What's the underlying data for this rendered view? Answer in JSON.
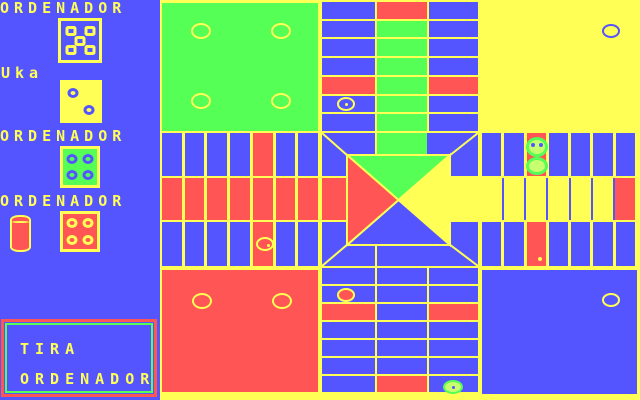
{
  "palette": {
    "blue": "#5555FF",
    "red": "#FF5555",
    "green": "#55FF55",
    "yellow": "#FFFF55"
  },
  "sidebar": {
    "rows": [
      {
        "label": "ORDENADOR"
      },
      {
        "label": "Uka"
      },
      {
        "label": "ORDENADOR"
      },
      {
        "label": "ORDENADOR"
      }
    ],
    "dice": [
      {
        "player": "ordenador-1",
        "value": 5,
        "face": "blue",
        "border": "yellow",
        "pip": "yellow",
        "pip_shape": "square",
        "x": 58,
        "y": 18,
        "w": 44,
        "h": 45
      },
      {
        "player": "Uka",
        "value": 2,
        "face": "yellow",
        "border": "yellow",
        "pip": "blue",
        "pip_shape": "round",
        "x": 60,
        "y": 80,
        "w": 42,
        "h": 43
      },
      {
        "player": "ordenador-2",
        "value": 4,
        "face": "green",
        "border": "yellow",
        "pip": "blue",
        "pip_shape": "round",
        "x": 60,
        "y": 146,
        "w": 40,
        "h": 42
      },
      {
        "player": "ordenador-3",
        "value": 4,
        "face": "red",
        "border": "yellow",
        "pip": "yellow",
        "pip_shape": "round",
        "x": 60,
        "y": 211,
        "w": 40,
        "h": 41
      }
    ],
    "action_box": {
      "line1": "TIRA",
      "line2": "ORDENADOR"
    }
  },
  "board": {
    "quadrants": [
      {
        "name": "green-home",
        "color": "green",
        "x": 162,
        "y": 3,
        "w": 156,
        "h": 128,
        "circles": [
          {
            "cx": 201,
            "cy": 31,
            "ring": "yellow",
            "rx": 10,
            "ry": 8
          },
          {
            "cx": 281,
            "cy": 31,
            "ring": "yellow",
            "rx": 10,
            "ry": 8
          },
          {
            "cx": 201,
            "cy": 101,
            "ring": "yellow",
            "rx": 10,
            "ry": 8
          },
          {
            "cx": 281,
            "cy": 101,
            "ring": "yellow",
            "rx": 10,
            "ry": 8
          }
        ]
      },
      {
        "name": "yellow-home",
        "color": "yellow",
        "x": 482,
        "y": 3,
        "w": 155,
        "h": 128,
        "circles": [
          {
            "cx": 611,
            "cy": 31,
            "ring": "blue",
            "rx": 9,
            "ry": 7
          }
        ]
      },
      {
        "name": "red-home",
        "color": "red",
        "x": 162,
        "y": 270,
        "w": 156,
        "h": 122,
        "circles": [
          {
            "cx": 202,
            "cy": 301,
            "ring": "yellow",
            "rx": 10,
            "ry": 8
          },
          {
            "cx": 282,
            "cy": 301,
            "ring": "yellow",
            "rx": 10,
            "ry": 8
          }
        ]
      },
      {
        "name": "blue-home",
        "color": "blue",
        "x": 482,
        "y": 270,
        "w": 155,
        "h": 124,
        "circles": [
          {
            "cx": 611,
            "cy": 300,
            "ring": "yellow",
            "rx": 9,
            "ry": 7
          }
        ]
      }
    ],
    "arms": [
      {
        "name": "arm-top-left-col",
        "x": 322,
        "y": 2,
        "w": 53,
        "h": 129,
        "dir": "rows",
        "gap": 2,
        "bg": "yellow",
        "cells": [
          "blue",
          "blue",
          "blue",
          "blue",
          "red",
          "blue",
          "blue"
        ]
      },
      {
        "name": "arm-top-mid-col",
        "x": 377,
        "y": 2,
        "w": 50,
        "h": 129,
        "dir": "rows",
        "gap": 2,
        "bg": "yellow",
        "cells": [
          "red",
          "green",
          "green",
          "green",
          "green",
          "green",
          "green"
        ]
      },
      {
        "name": "arm-top-right-col",
        "x": 429,
        "y": 2,
        "w": 49,
        "h": 129,
        "dir": "rows",
        "gap": 2,
        "bg": "yellow",
        "cells": [
          "blue",
          "blue",
          "blue",
          "blue",
          "red",
          "blue",
          "blue"
        ]
      },
      {
        "name": "arm-left-top-row",
        "x": 162,
        "y": 133,
        "w": 156,
        "h": 43,
        "dir": "cols",
        "gap": 3,
        "bg": "yellow",
        "cells": [
          "blue",
          "blue",
          "blue",
          "blue",
          "red",
          "blue",
          "blue"
        ]
      },
      {
        "name": "arm-left-mid-row",
        "x": 162,
        "y": 178,
        "w": 156,
        "h": 42,
        "dir": "cols",
        "gap": 3,
        "bg": "yellow",
        "cells": [
          "red",
          "red",
          "red",
          "red",
          "red",
          "red",
          "red"
        ]
      },
      {
        "name": "arm-left-bottom-row",
        "x": 162,
        "y": 222,
        "w": 156,
        "h": 44,
        "dir": "cols",
        "gap": 3,
        "bg": "yellow",
        "cells": [
          "blue",
          "blue",
          "blue",
          "blue",
          "red",
          "blue",
          "blue"
        ]
      },
      {
        "name": "arm-right-top-row",
        "x": 482,
        "y": 133,
        "w": 153,
        "h": 43,
        "dir": "cols",
        "gap": 3,
        "bg": "yellow",
        "cells": [
          "blue",
          "blue",
          "red",
          "blue",
          "blue",
          "blue",
          "blue"
        ]
      },
      {
        "name": "arm-right-mid-row",
        "x": 482,
        "y": 178,
        "w": 153,
        "h": 42,
        "dir": "cols",
        "gap": 2,
        "bg": "blue",
        "cells": [
          "yellow",
          "yellow",
          "yellow",
          "yellow",
          "yellow",
          "yellow",
          "red"
        ]
      },
      {
        "name": "arm-right-bottom-row",
        "x": 482,
        "y": 222,
        "w": 153,
        "h": 44,
        "dir": "cols",
        "gap": 3,
        "bg": "yellow",
        "cells": [
          "blue",
          "blue",
          "red",
          "blue",
          "blue",
          "blue",
          "blue"
        ]
      },
      {
        "name": "arm-bottom-left-col",
        "x": 322,
        "y": 268,
        "w": 53,
        "h": 124,
        "dir": "rows",
        "gap": 2,
        "bg": "yellow",
        "cells": [
          "blue",
          "blue",
          "red",
          "blue",
          "blue",
          "blue",
          "blue"
        ]
      },
      {
        "name": "arm-bottom-mid-col",
        "x": 377,
        "y": 268,
        "w": 50,
        "h": 124,
        "dir": "rows",
        "gap": 2,
        "bg": "yellow",
        "cells": [
          "blue",
          "blue",
          "blue",
          "blue",
          "blue",
          "blue",
          "red"
        ]
      },
      {
        "name": "arm-bottom-right-col",
        "x": 429,
        "y": 268,
        "w": 49,
        "h": 124,
        "dir": "rows",
        "gap": 2,
        "bg": "yellow",
        "cells": [
          "blue",
          "blue",
          "red",
          "blue",
          "blue",
          "blue",
          "blue"
        ]
      }
    ],
    "patches": [
      {
        "x": 322,
        "y": 133,
        "w": 53,
        "h": 43
      },
      {
        "x": 426,
        "y": 133,
        "w": 52,
        "h": 43
      },
      {
        "x": 322,
        "y": 222,
        "w": 53,
        "h": 44
      },
      {
        "x": 426,
        "y": 222,
        "w": 52,
        "h": 44
      }
    ],
    "entries": [
      {
        "name": "entry-green",
        "color": "green",
        "x": 377,
        "y": 133,
        "w": 50,
        "h": 21
      },
      {
        "name": "entry-red",
        "color": "red",
        "x": 322,
        "y": 178,
        "w": 24,
        "h": 42
      },
      {
        "name": "entry-yellow",
        "color": "yellow",
        "x": 453,
        "y": 178,
        "w": 25,
        "h": 42
      },
      {
        "name": "entry-blue",
        "color": "blue",
        "x": 377,
        "y": 246,
        "w": 50,
        "h": 20
      }
    ],
    "center": {
      "x": 347,
      "y": 155,
      "w": 103,
      "h": 90,
      "top": "green",
      "right": "yellow",
      "bottom": "blue",
      "left": "red",
      "line": "yellow"
    },
    "diagonals": [
      [
        322,
        133,
        348,
        156
      ],
      [
        478,
        133,
        449,
        156
      ],
      [
        322,
        266,
        348,
        244
      ],
      [
        478,
        266,
        449,
        244
      ]
    ]
  },
  "pieces": [
    {
      "name": "piece-yellow-track-top",
      "x": 346,
      "y": 104,
      "rx": 9,
      "ry": 7,
      "ring": "yellow",
      "ring_w": 2,
      "fill": "transparent",
      "marks": [
        {
          "dx": 0,
          "dy": 0,
          "c": "yellow",
          "s": 3
        }
      ]
    },
    {
      "name": "piece-green-pair-top",
      "x": 537,
      "y": 147,
      "rx": 11,
      "ry": 10,
      "ring": "green",
      "ring_w": 3,
      "fill": "#C8FF6E",
      "marks": [
        {
          "dx": -4,
          "dy": -2,
          "c": "blue",
          "s": 4
        },
        {
          "dx": 4,
          "dy": -2,
          "c": "blue",
          "s": 4
        }
      ]
    },
    {
      "name": "piece-green-pair-bottom",
      "x": 537,
      "y": 166,
      "rx": 11,
      "ry": 9,
      "ring": "green",
      "ring_w": 3,
      "fill": "#C8FF6E",
      "marks": []
    },
    {
      "name": "piece-green-track-bottom",
      "x": 453,
      "y": 387,
      "rx": 10,
      "ry": 7,
      "ring": "green",
      "ring_w": 2,
      "fill": "#C8FF6E",
      "marks": [
        {
          "dx": 0,
          "dy": 0,
          "c": "blue",
          "s": 3
        }
      ]
    },
    {
      "name": "piece-red-track",
      "x": 346,
      "y": 295,
      "rx": 9,
      "ry": 7,
      "ring": "yellow",
      "ring_w": 2,
      "fill": "red",
      "marks": []
    },
    {
      "name": "piece-yellow-track-left",
      "x": 265,
      "y": 244,
      "rx": 9,
      "ry": 7,
      "ring": "yellow",
      "ring_w": 2,
      "fill": "transparent",
      "marks": [
        {
          "dx": 3,
          "dy": 1,
          "c": "yellow",
          "s": 3
        }
      ]
    },
    {
      "name": "piece-dot-right-arm",
      "x": 540,
      "y": 259,
      "rx": 2,
      "ry": 2,
      "ring": "yellow",
      "ring_w": 0,
      "fill": "yellow",
      "marks": []
    }
  ]
}
